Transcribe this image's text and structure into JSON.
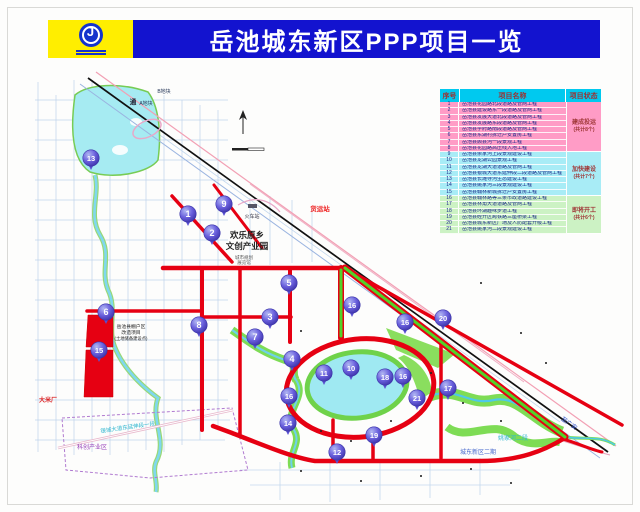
{
  "header": {
    "title": "岳池城东新区PPP项目一览",
    "logo": "huaxi-emblem"
  },
  "table": {
    "headers": [
      "序号",
      "项目名称",
      "项目状态"
    ],
    "rows": [
      {
        "no": "1",
        "name": "岳池县花园路北段道路及管网工程",
        "g": 0
      },
      {
        "no": "2",
        "name": "岳池县建设路东一段道路及管网工程",
        "g": 0
      },
      {
        "no": "3",
        "name": "岳池县发展大道北段道路及管网工程",
        "g": 0
      },
      {
        "no": "4",
        "name": "岳池县发展路东段道路及管网工程",
        "g": 0
      },
      {
        "no": "5",
        "name": "岳池县学府路南段道路及管网工程",
        "g": 0
      },
      {
        "no": "6",
        "name": "岳池县东湖村拆迁户安置房工程",
        "g": 0
      },
      {
        "no": "7",
        "name": "岳池县顾县河一段景观工程",
        "g": 0
      },
      {
        "no": "8",
        "name": "岳池县花园路高压线入地工程",
        "g": 0
      },
      {
        "no": "9",
        "name": "岳池县余家河上段景观建设工程",
        "g": 1
      },
      {
        "no": "10",
        "name": "岳池县龙湖公园景观工程",
        "g": 1
      },
      {
        "no": "11",
        "name": "岳池县龙湖大道道路及管网工程",
        "g": 1
      },
      {
        "no": "12",
        "name": "岳池县银城大道东延伸段二段道路及管网工程",
        "g": 1
      },
      {
        "no": "13",
        "name": "岳池县长滩寺河生态建设工程",
        "g": 1
      },
      {
        "no": "14",
        "name": "岳池县姚家河三段景观建设工程",
        "g": 1
      },
      {
        "no": "15",
        "name": "岳池县翰林新城拆迁户安置房工程",
        "g": 1
      },
      {
        "no": "16",
        "name": "岳池县翰林路等三条市政道路建设工程",
        "g": 2
      },
      {
        "no": "17",
        "name": "岳池县林角大道道路及管网工程",
        "g": 2
      },
      {
        "no": "18",
        "name": "岳池县环湖趣味步道工程",
        "g": 2
      },
      {
        "no": "19",
        "name": "岳池县经开区跨铁路三座桥梁工程",
        "g": 2
      },
      {
        "no": "20",
        "name": "岳池县城东新区广场及人防配套升级工程",
        "g": 2
      },
      {
        "no": "21",
        "name": "岳池县姚家河二段景观建设工程",
        "g": 2
      }
    ],
    "groups": [
      {
        "status": "建成投运",
        "count": "(共计8个)",
        "rows": 8,
        "color": "#ff9cc6"
      },
      {
        "status": "加快建设",
        "count": "(共计7个)",
        "rows": 7,
        "color": "#a8ecf6"
      },
      {
        "status": "即将开工",
        "count": "(共计6个)",
        "rows": 6,
        "color": "#ccf2c4"
      }
    ]
  },
  "map": {
    "markers": [
      {
        "n": "13",
        "x": 91,
        "y": 158
      },
      {
        "n": "1",
        "x": 188,
        "y": 214
      },
      {
        "n": "9",
        "x": 224,
        "y": 204
      },
      {
        "n": "2",
        "x": 212,
        "y": 233
      },
      {
        "n": "5",
        "x": 289,
        "y": 283
      },
      {
        "n": "6",
        "x": 106,
        "y": 312
      },
      {
        "n": "3",
        "x": 270,
        "y": 317
      },
      {
        "n": "8",
        "x": 199,
        "y": 325
      },
      {
        "n": "16",
        "x": 352,
        "y": 305
      },
      {
        "n": "16",
        "x": 405,
        "y": 322
      },
      {
        "n": "20",
        "x": 443,
        "y": 318
      },
      {
        "n": "7",
        "x": 255,
        "y": 337
      },
      {
        "n": "15",
        "x": 99,
        "y": 350
      },
      {
        "n": "4",
        "x": 292,
        "y": 359
      },
      {
        "n": "10",
        "x": 351,
        "y": 368
      },
      {
        "n": "11",
        "x": 324,
        "y": 373
      },
      {
        "n": "18",
        "x": 385,
        "y": 377
      },
      {
        "n": "16",
        "x": 403,
        "y": 376
      },
      {
        "n": "17",
        "x": 448,
        "y": 388
      },
      {
        "n": "16",
        "x": 289,
        "y": 396
      },
      {
        "n": "21",
        "x": 417,
        "y": 398
      },
      {
        "n": "14",
        "x": 288,
        "y": 423
      },
      {
        "n": "19",
        "x": 374,
        "y": 435
      },
      {
        "n": "12",
        "x": 337,
        "y": 452
      }
    ],
    "labels": [
      {
        "t": "欢乐原乡",
        "x": 247,
        "y": 238,
        "s": 8.5,
        "c": "#222222",
        "b": 1
      },
      {
        "t": "文创产业园",
        "x": 247,
        "y": 249,
        "s": 8.5,
        "c": "#222222",
        "b": 1
      },
      {
        "t": "货运站",
        "x": 320,
        "y": 211,
        "s": 6.5,
        "c": "#ee2222",
        "b": 1
      },
      {
        "t": "火车站",
        "x": 252,
        "y": 218,
        "s": 5,
        "c": "#333344"
      },
      {
        "t": "城市规划",
        "x": 244,
        "y": 259,
        "s": 4.5,
        "c": "#555555"
      },
      {
        "t": "展览馆",
        "x": 244,
        "y": 264,
        "s": 4.5,
        "c": "#555555"
      },
      {
        "t": "岳池县棚户区",
        "x": 131,
        "y": 328,
        "s": 4.8,
        "c": "#222222"
      },
      {
        "t": "改造项目",
        "x": 131,
        "y": 334,
        "s": 4.8,
        "c": "#222222"
      },
      {
        "t": "(土地储备建设点)",
        "x": 131,
        "y": 340,
        "s": 4.3,
        "c": "#222222"
      },
      {
        "t": "大米厂",
        "x": 48,
        "y": 402,
        "s": 6,
        "c": "#dd2222",
        "b": 1
      },
      {
        "t": "银城大道东延伸段一段",
        "x": 128,
        "y": 429,
        "s": 5.5,
        "c": "#2fb6cf",
        "r": -8
      },
      {
        "t": "科创产业区",
        "x": 92,
        "y": 449,
        "s": 6,
        "c": "#9944bb"
      },
      {
        "t": "姚家河二段",
        "x": 513,
        "y": 440,
        "s": 6,
        "c": "#2fb6cf"
      },
      {
        "t": "城东新区二期",
        "x": 478,
        "y": 454,
        "s": 6,
        "c": "#4466cc"
      },
      {
        "t": "至广安",
        "x": 568,
        "y": 425,
        "s": 6,
        "c": "#3355cc",
        "r": 35
      },
      {
        "t": "A地块",
        "x": 146,
        "y": 105,
        "s": 5,
        "c": "#223355"
      },
      {
        "t": "B地块",
        "x": 164,
        "y": 93,
        "s": 5,
        "c": "#223355"
      },
      {
        "t": "通",
        "x": 133,
        "y": 104,
        "s": 6.5,
        "c": "#222233",
        "b": 1
      }
    ],
    "marker_color": "#5a50d0",
    "road_color": "#e60012",
    "green_road_color": "#52d228",
    "water_color": "#9fe9f2"
  }
}
